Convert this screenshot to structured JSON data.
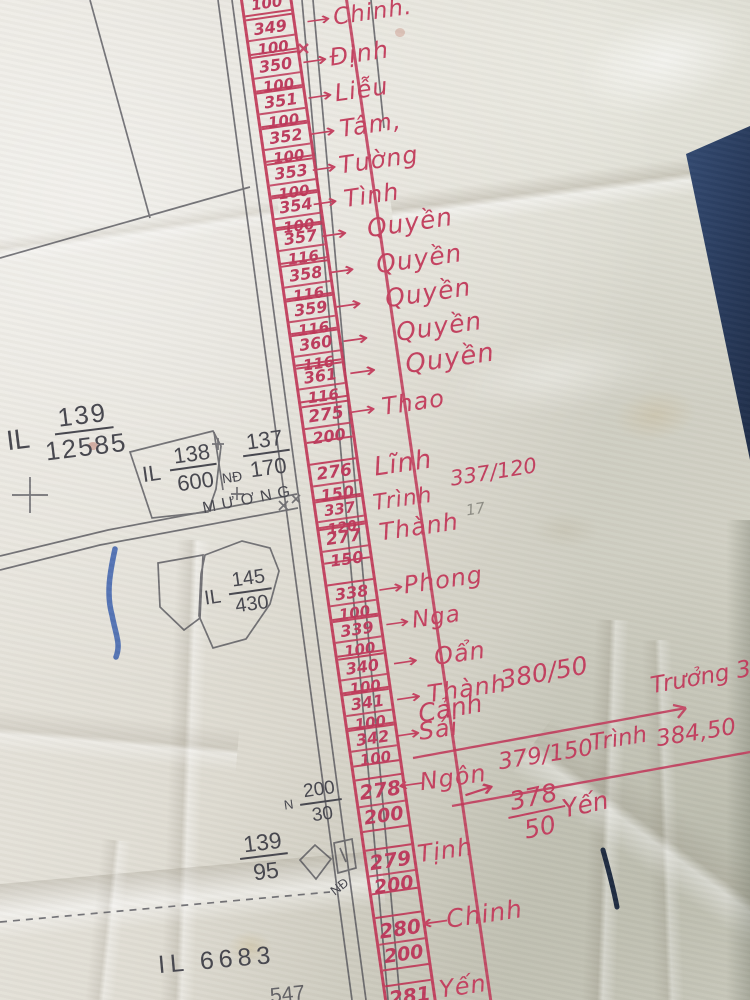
{
  "ledger": {
    "top_partial_den": "100",
    "rows": [
      {
        "num": "349",
        "den": "100",
        "arrow": "→",
        "name": "Chinh."
      },
      {
        "num": "350",
        "den": "100",
        "arrow": "→",
        "name": "Định"
      },
      {
        "num": "351",
        "den": "100",
        "arrow": "→",
        "name": "Liễu"
      },
      {
        "num": "352",
        "den": "100",
        "arrow": "→",
        "name": "Tâm,"
      },
      {
        "num": "353",
        "den": "100",
        "arrow": "→",
        "name": "Tường"
      },
      {
        "num": "354",
        "den": "100",
        "arrow": "→",
        "name": "Tình"
      },
      {
        "num": "357",
        "den": "116",
        "arrow": "→",
        "name": "Quyền"
      },
      {
        "num": "358",
        "den": "116",
        "arrow": "→",
        "name": "Quyền"
      },
      {
        "num": "359",
        "den": "116",
        "arrow": "→",
        "name": "Quyền"
      },
      {
        "num": "360",
        "den": "116",
        "arrow": "→",
        "name": "Quyền"
      },
      {
        "num": "361",
        "den": "116",
        "arrow": "→",
        "name": "Quyền"
      },
      {
        "num": "275",
        "den": "200",
        "arrow": "→",
        "name": "Thao"
      },
      {
        "num": "276",
        "den": "150",
        "arrow": "",
        "name": "Lĩnh"
      },
      {
        "num": "337",
        "den": "120",
        "arrow": "",
        "name": "Trình"
      },
      {
        "num": "277",
        "den": "150",
        "arrow": "",
        "name": "Thành"
      },
      {
        "num": "338",
        "den": "100",
        "arrow": "→",
        "name": "Phong"
      },
      {
        "num": "339",
        "den": "100",
        "arrow": "→",
        "name": "Nga"
      },
      {
        "num": "340",
        "den": "100",
        "arrow": "→",
        "name": "Oẩn"
      },
      {
        "num": "341",
        "den": "100",
        "arrow": "→",
        "name": "Thành"
      },
      {
        "num": "342",
        "den": "100",
        "arrow": "→",
        "name": "Sái"
      },
      {
        "num": "278",
        "den": "200",
        "arrow": "←",
        "name": "Ngôn"
      },
      {
        "num": "279",
        "den": "200",
        "arrow": "",
        "name": "Tịnh"
      },
      {
        "num": "280",
        "den": "200",
        "arrow": "←",
        "name": "Chinh"
      },
      {
        "num": "281",
        "den": "",
        "arrow": "",
        "name": "Yến"
      }
    ],
    "branch": {
      "note": "337/120",
      "canh": "Cảnh",
      "val_380": "380/50",
      "truong": "Trưởng 381",
      "val_379": "379/150",
      "trinh": "Trình",
      "total": "384,50",
      "frac_378_num": "378",
      "frac_378_den": "50",
      "yen": "Yến",
      "trail_arrow": "→"
    }
  },
  "parcels": {
    "il_139": {
      "prefix": "IL",
      "num": "139",
      "den": "12585"
    },
    "il_138": {
      "prefix": "IL",
      "num": "138",
      "den": "600"
    },
    "p_137": {
      "num": "137",
      "den": "170"
    },
    "nd_upper": "NĐ",
    "muong": "MƯƠNG",
    "il_145": {
      "prefix": "IL",
      "num": "145",
      "den": "430"
    },
    "north_mark": "N",
    "p_200": {
      "num": "200",
      "den": "30"
    },
    "p_139b": {
      "num": "139",
      "den": "95"
    },
    "nd_lower": "NĐ",
    "il_6683": "IL 6683",
    "bottom_partial": "547",
    "pencil_note": "17"
  },
  "colors": {
    "red_ink": "#c23e5e",
    "black_print": "#45454d",
    "blue_pen": "#3a5fad",
    "navy_object": "#2a3c5e"
  }
}
